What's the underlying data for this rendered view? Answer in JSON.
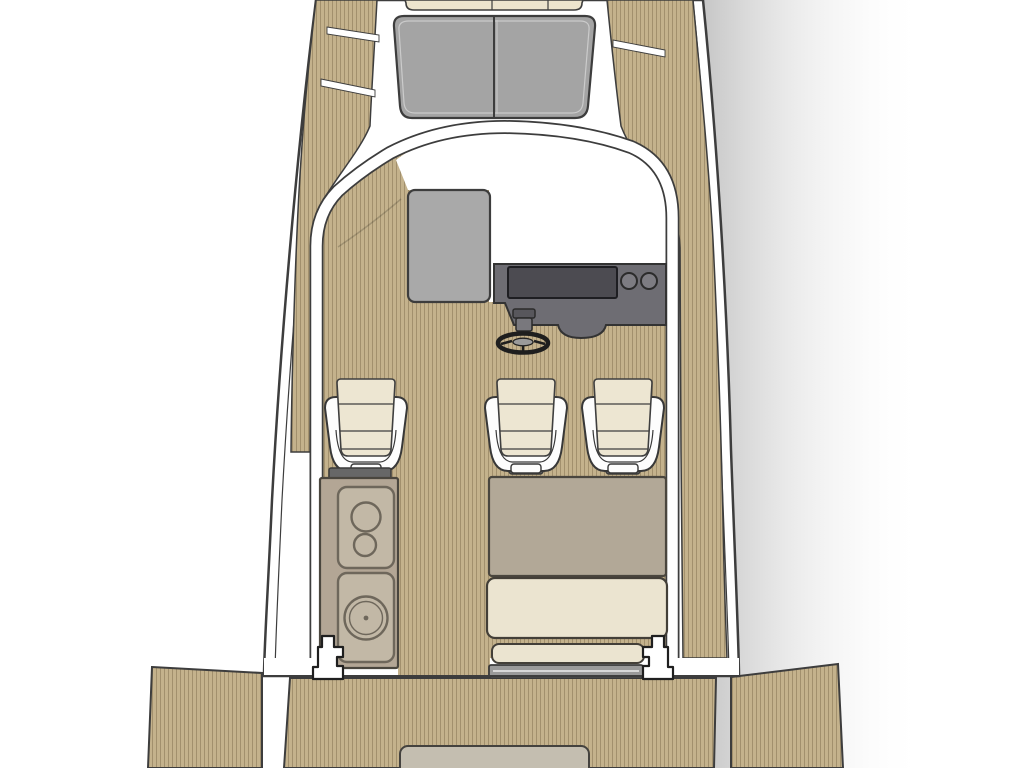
{
  "diagram": {
    "kind": "boat-deck-floor-plan",
    "orientation": "bow-up",
    "visible_text": [],
    "components": {
      "bow_sunpad": {
        "seams": 2
      },
      "foredeck_hatch_panels": 2,
      "companionway_hatch": 1,
      "helm_console": {
        "instrument_panel": 1,
        "round_gauges": 2,
        "steering_wheel": 1
      },
      "helm_seats": 3,
      "galley_unit": {
        "burners": 2,
        "sink": 1
      },
      "aft_bench": {
        "backrest": 1,
        "seat_cushion": 1,
        "step": 1
      },
      "transom_cleats": 2,
      "swim_platform": 1,
      "fold_down_platforms": 2,
      "engine_hatch": 1
    }
  },
  "colors": {
    "background": "#ffffff",
    "outline": "#3d3d3d",
    "teak_base": "#c4b28c",
    "teak_stripe": "#a2906d",
    "hull_white": "#ffffff",
    "sunpad_cream": "#ece4cd",
    "windshield_gray": "#a4a4a4",
    "windshield_highlight": "#cbcbcb",
    "hatch_gray": "#a9a9a9",
    "console_gray": "#6e6d73",
    "instrument_gray": "#4c4b51",
    "gauge_gray": "#7d7c82",
    "wheel_dark": "#1e1e1e",
    "wheel_hub": "#9a9a9a",
    "seat_shell_white": "#fdfdfd",
    "seat_cushion_cream": "#ede6d2",
    "seat_base_gray": "#676767",
    "furniture_beige": "#b3a695",
    "furniture_panel": "#c2b8a6",
    "furniture_line": "#6e675b",
    "bench_backrest": "#b2a897",
    "bench_cushion": "#ebe4d0",
    "step_bar_gray": "#9a9a9a",
    "step_bar_light": "#d8d8d8",
    "engine_hatch_gray": "#c4beb0",
    "shadow_gray": "#6e6e6e"
  }
}
